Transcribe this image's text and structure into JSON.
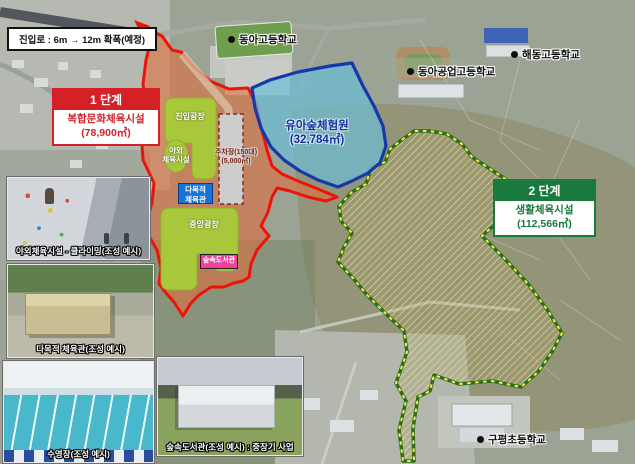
{
  "road_note": {
    "text": "진입로 : 6m → 12m 확폭(예정)"
  },
  "schools": [
    {
      "name": "동아고등학교"
    },
    {
      "name": "해동고등학교"
    },
    {
      "name": "동아공업고등학교"
    },
    {
      "name": "구평초등학교"
    }
  ],
  "phase1": {
    "badge": "1 단계",
    "title": "복합문화체육시설",
    "area": "(78,900㎡)",
    "color": "#d42127",
    "zone_border": "#ee1309",
    "zone_fill": "rgba(225,108,58,0.58)"
  },
  "phase2": {
    "badge": "2 단계",
    "title": "생활체육시설",
    "area": "(112,566㎡)",
    "color": "#1a7a3e",
    "zone_border": "#2a6e1f",
    "zone_dash": "#ffe84a"
  },
  "forest_zone": {
    "title": "유아숲체험원",
    "area": "(32,784㎡)",
    "color": "#16309d",
    "zone_border": "#1638a8",
    "zone_fill": "rgba(108,190,214,0.72)"
  },
  "facilities": {
    "entrance_plaza": "진입광장",
    "outdoor_line1": "야외",
    "outdoor_line2": "체육시설",
    "parking_line1": "주차장(150대)",
    "parking_line2": "(5,000㎡)",
    "gym_line1": "다목적",
    "gym_line2": "체육관",
    "central_plaza": "중앙광장",
    "library": "숲속도서관",
    "plaza_color": "#a9c73b",
    "gym_box_color": "#1a72d6",
    "library_box_color": "#f0409c"
  },
  "photos": [
    {
      "caption": "야외체육시설 - 클라이밍(조성 예시)"
    },
    {
      "caption": "다목적 체육관(조성 예시)"
    },
    {
      "caption": "수영장(조성 예시)"
    },
    {
      "caption": "숲속도서관(조성 예시) : 중장기 사업"
    }
  ]
}
